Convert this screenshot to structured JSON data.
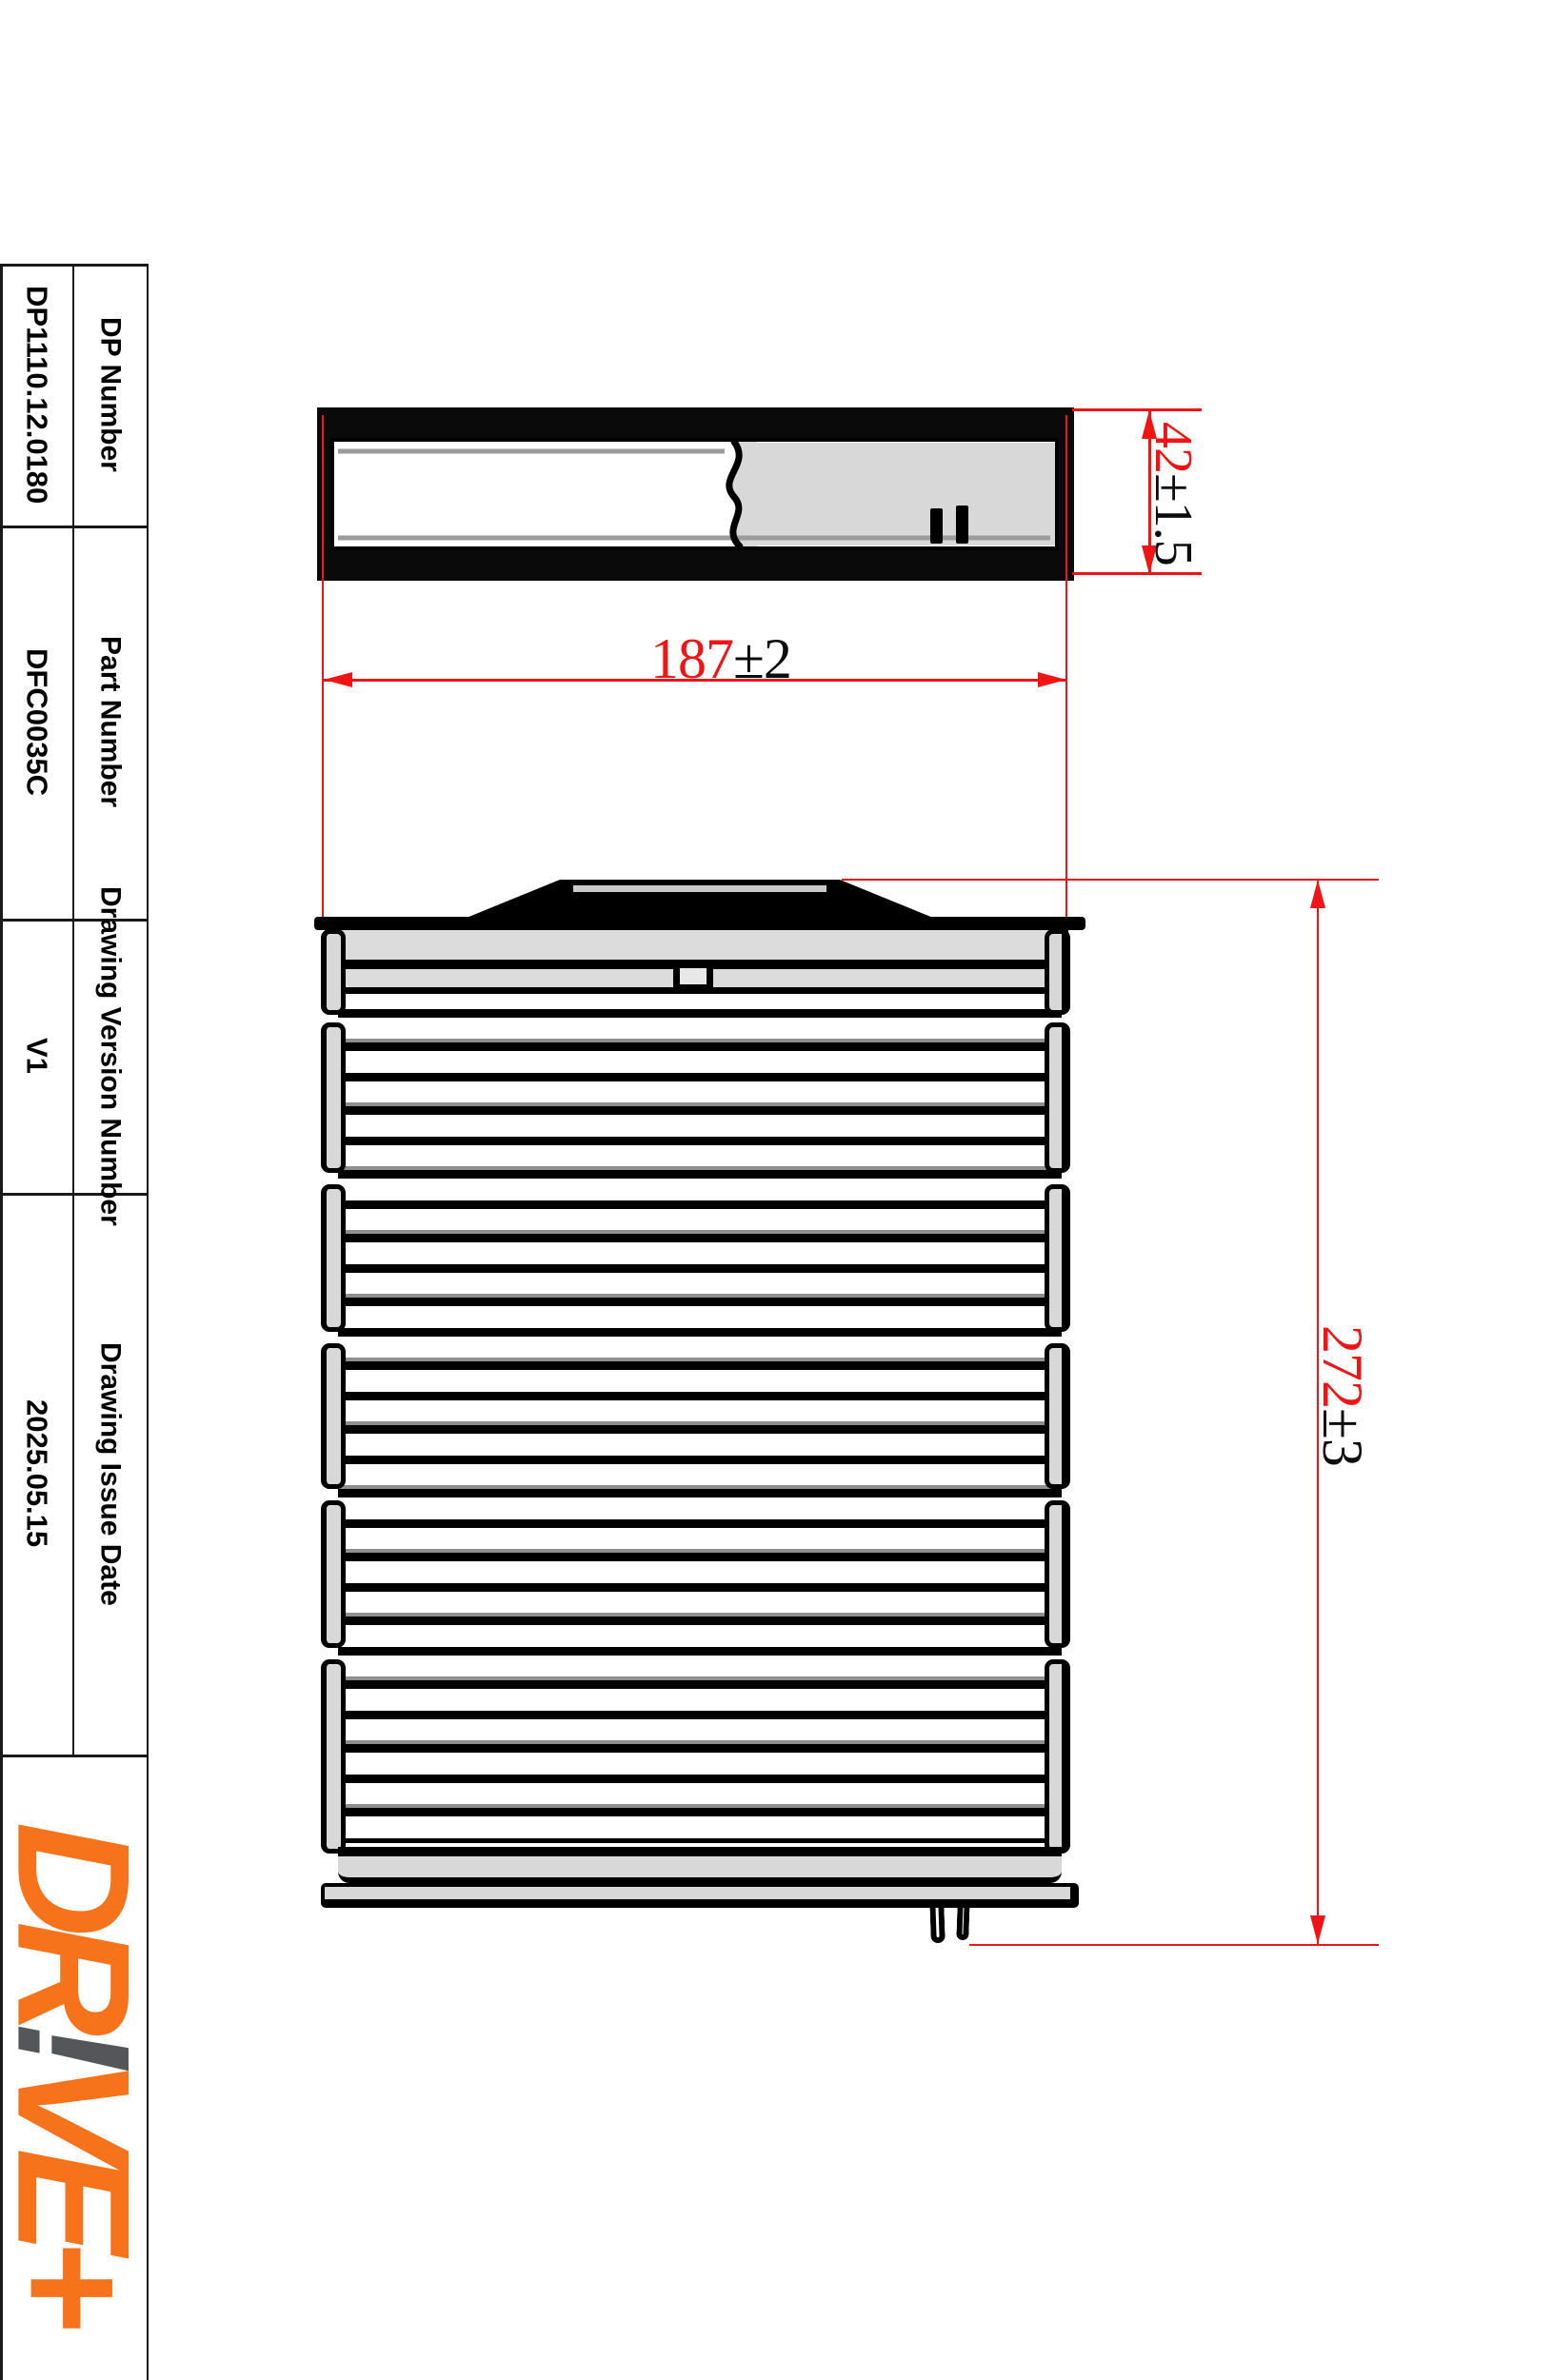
{
  "title_block": {
    "rows": [
      {
        "label": "DP Number",
        "value": "DP1110.12.0180"
      },
      {
        "label": "Part Number",
        "value": "DFC0035C"
      },
      {
        "label": "Drawing Version Number",
        "value": "V1"
      },
      {
        "label": "Drawing Issue Date",
        "value": "2025.05.15"
      }
    ]
  },
  "logo": {
    "part1": "DR",
    "part2": "!",
    "part3": "VE+",
    "orange": "#F6731B",
    "gray": "#55565A"
  },
  "dimensions": {
    "width": {
      "value": "187",
      "tolerance": "±2"
    },
    "depth": {
      "value": "42",
      "tolerance": "±1.5"
    },
    "height": {
      "value": "272",
      "tolerance": "±3"
    }
  },
  "colors": {
    "dimension_red": "#F01414",
    "fill_gray": "#D8D8D8",
    "line_black": "#000000"
  }
}
